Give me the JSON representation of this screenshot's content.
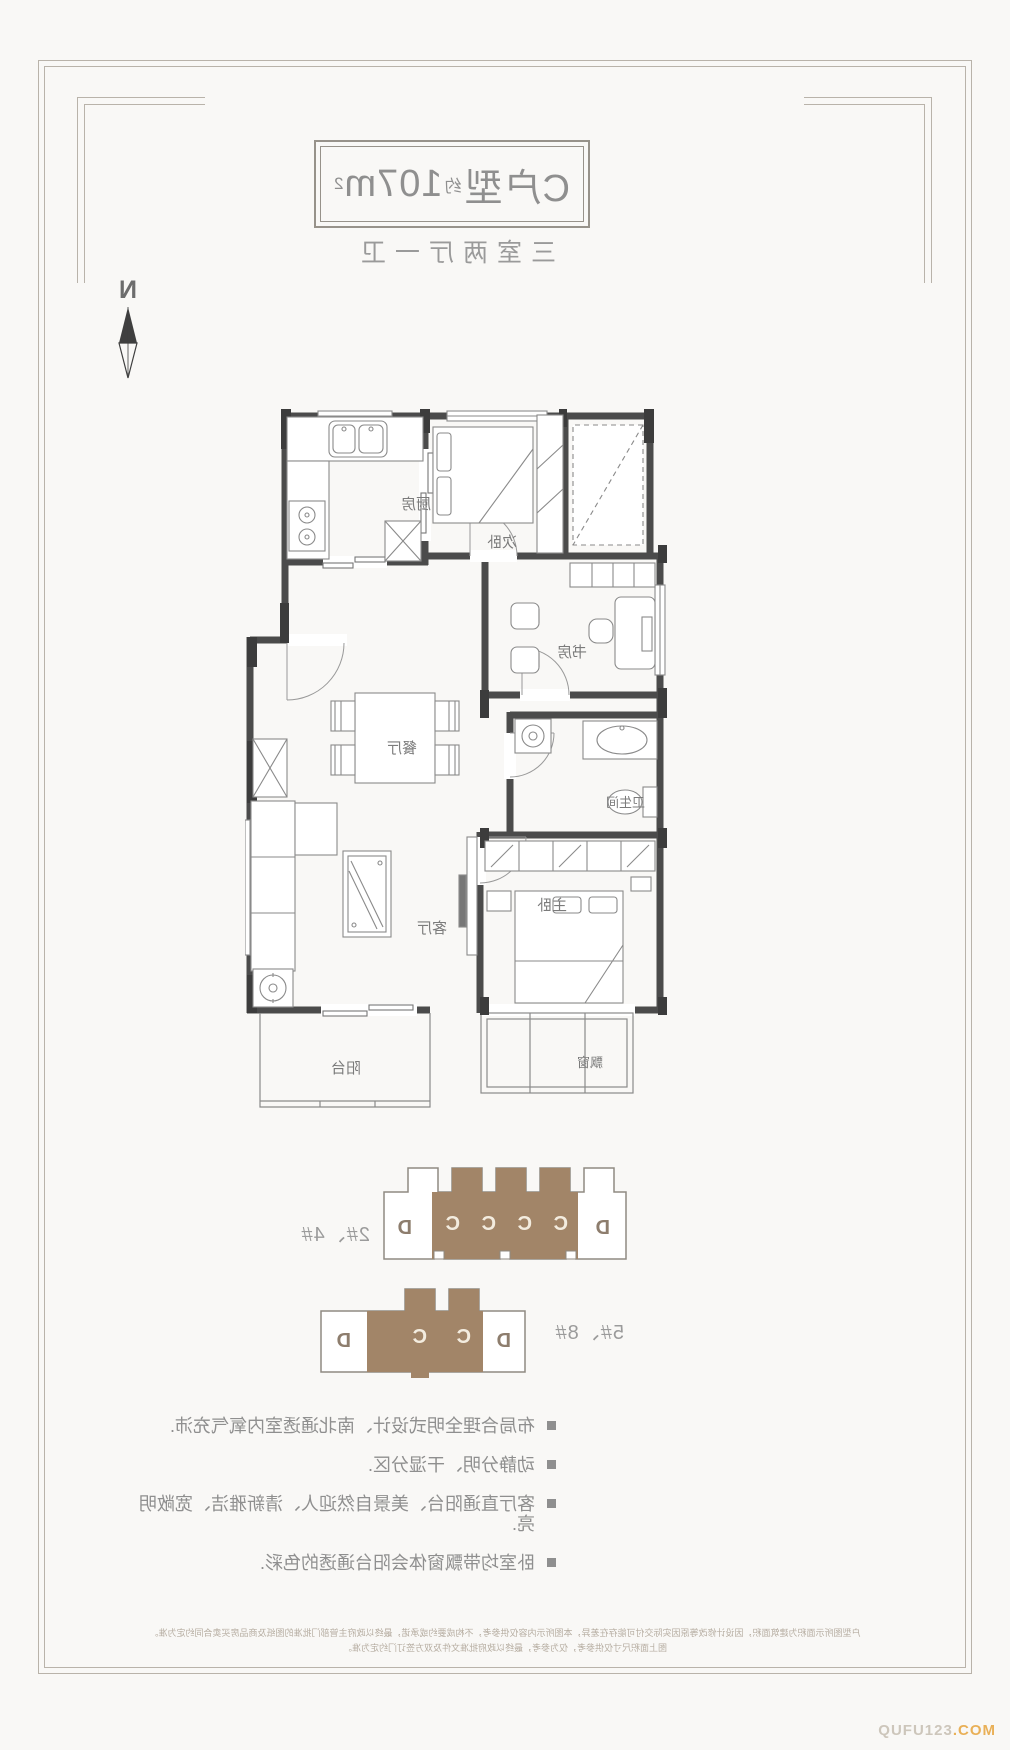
{
  "title": {
    "prefix": "C户型",
    "approx": "约",
    "area": "107m",
    "sup": "2"
  },
  "subtitle": "三室两厅一卫",
  "compass": {
    "letter": "N"
  },
  "plan": {
    "rooms": {
      "kitchen": "厨房",
      "bedroom2": "次卧",
      "study": "书房",
      "dining": "餐厅",
      "living": "客厅",
      "bath": "卫生间",
      "master": "主卧",
      "balcony": "阳台",
      "baywindow": "飘窗"
    }
  },
  "buildings": [
    {
      "label": "2#、4#",
      "units": [
        "D",
        "C",
        "C",
        "C",
        "C",
        "D"
      ]
    },
    {
      "label": "5#、8#",
      "units": [
        "D",
        "C",
        "C",
        "D"
      ]
    }
  ],
  "features": [
    "布局合理全明式设计、南北通透室内氧气充沛.",
    "动静分明、干湿分区.",
    "客厅直通阳台、美景自然迎人、清新雅洁、宽敞明亮.",
    "卧室均带飘窗体会阳台通透的色彩."
  ],
  "disclaimer": {
    "line1": "户型图所示面积为建筑面积，因设计修改等原因实际交付可能存在差异，本图所示内容仅供参考，不构成要约或承诺，最终以政府主管部门批准的图纸及商品房买卖合同约定为准。",
    "line2": "图上面积尺寸仅供参考，仅为参考，最终以政府批准文件及双方签订门约定为准。"
  },
  "watermark": {
    "name": "QUFU123",
    "tld": ".COM"
  },
  "colors": {
    "wall": "#4b4b4b",
    "brown": "#a28568",
    "frame": "#b9b3aa",
    "text": "#8f8f8f"
  }
}
